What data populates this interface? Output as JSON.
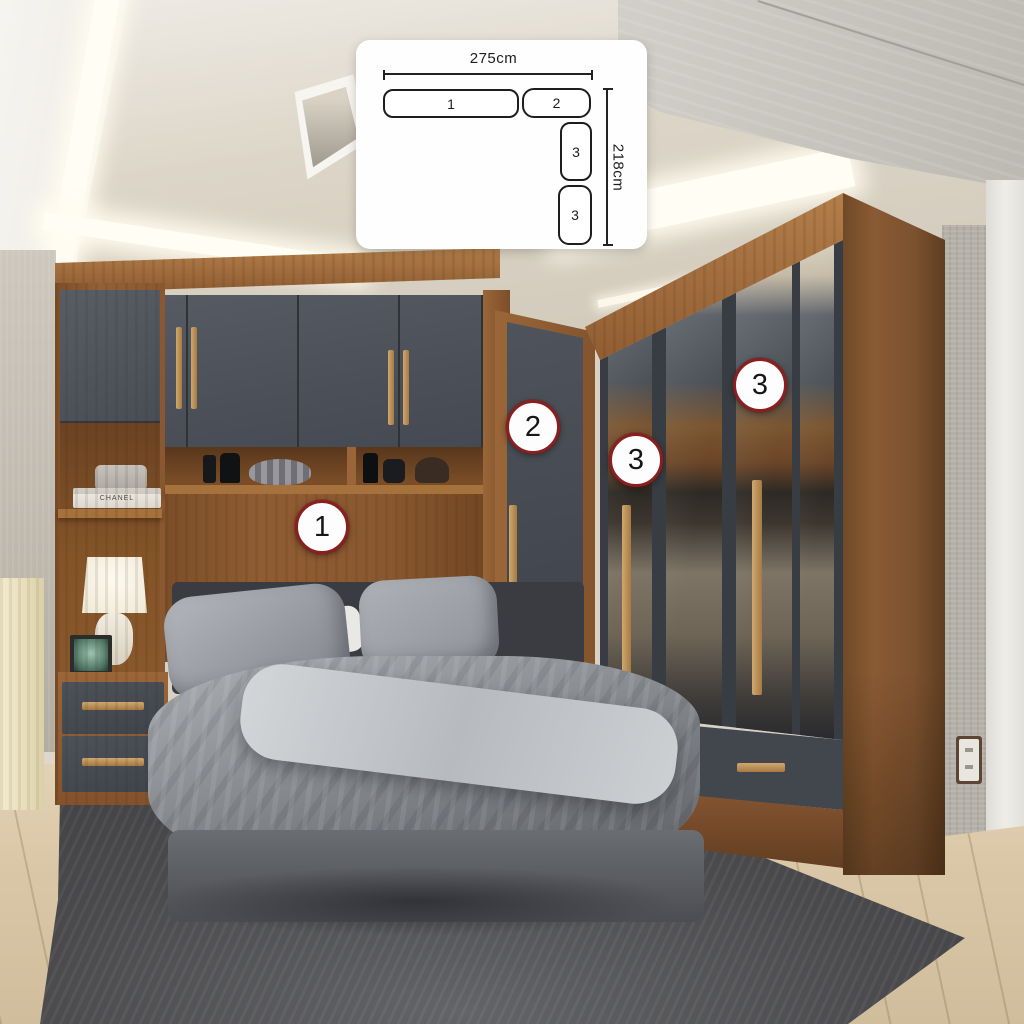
{
  "diagram": {
    "width_label": "275cm",
    "height_label": "218cm",
    "boxes": [
      {
        "label": "1"
      },
      {
        "label": "2"
      },
      {
        "label": "3"
      },
      {
        "label": "3"
      }
    ]
  },
  "callouts": [
    {
      "label": "1"
    },
    {
      "label": "2"
    },
    {
      "label": "3"
    },
    {
      "label": "3"
    }
  ],
  "decor": {
    "book_spine": "CHANEL"
  },
  "colors": {
    "callout_border": "#8a1f1f",
    "callout_bg": "#fdfdfd",
    "diagram_line": "#1d1d1d",
    "card_bg": "#fefefe",
    "wood": "#8a5830",
    "door_gray": "#4b5058",
    "cove_light": "#fffdf4",
    "rug": "#4a4a4d",
    "floor": "#dac7a7"
  }
}
